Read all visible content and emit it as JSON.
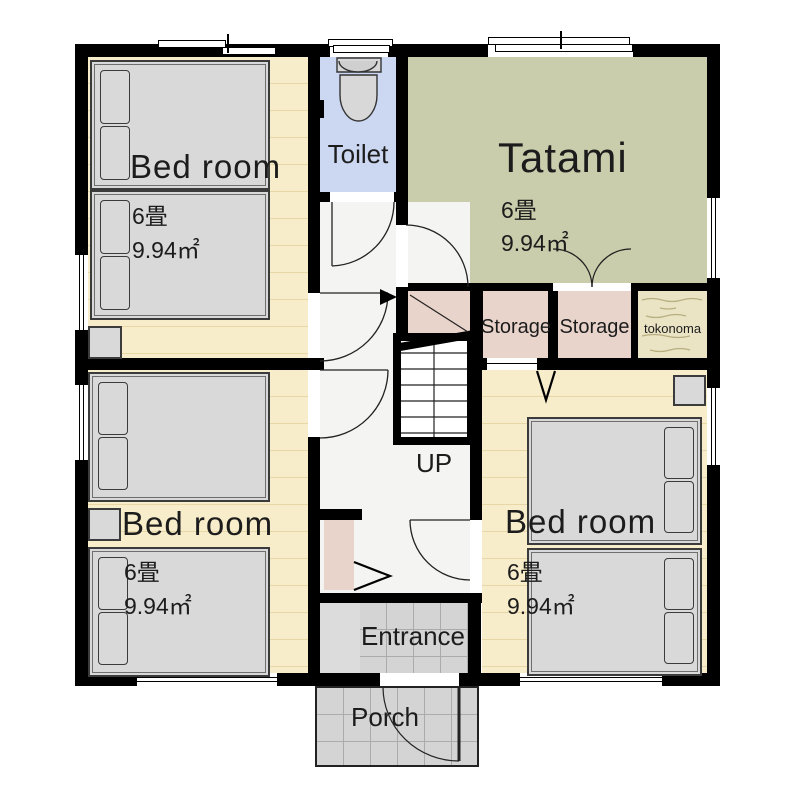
{
  "rooms": {
    "bedroom_top_left": {
      "name": "Bed room",
      "tatami_count": "6畳",
      "area": "9.94㎡"
    },
    "bedroom_bottom_left": {
      "name": "Bed room",
      "tatami_count": "6畳",
      "area": "9.94㎡"
    },
    "bedroom_bottom_right": {
      "name": "Bed room",
      "tatami_count": "6畳",
      "area": "9.94㎡"
    },
    "tatami_room": {
      "name": "Tatami",
      "tatami_count": "6畳",
      "area": "9.94㎡"
    },
    "toilet": {
      "name": "Toilet"
    },
    "storage_left": {
      "name": "Storage"
    },
    "storage_right": {
      "name": "Storage"
    },
    "tokonoma": {
      "name": "tokonoma"
    },
    "stairs": {
      "direction_label": "UP"
    },
    "entrance": {
      "name": "Entrance"
    },
    "porch": {
      "name": "Porch"
    }
  },
  "colors": {
    "wall": "#000000",
    "wood_floor": "#f8edca",
    "wood_floor_line": "#e8d7a6",
    "tatami_floor": "#c9cdab",
    "toilet_floor": "#ccd8f2",
    "storage_floor": "#e9d4cb",
    "tokonoma_floor": "#eae4c5",
    "hall_floor": "#f4f4f2",
    "tile_floor": "#d4d4d4",
    "bed_fill": "#d9d9d9",
    "text": "#1c1c1c"
  }
}
